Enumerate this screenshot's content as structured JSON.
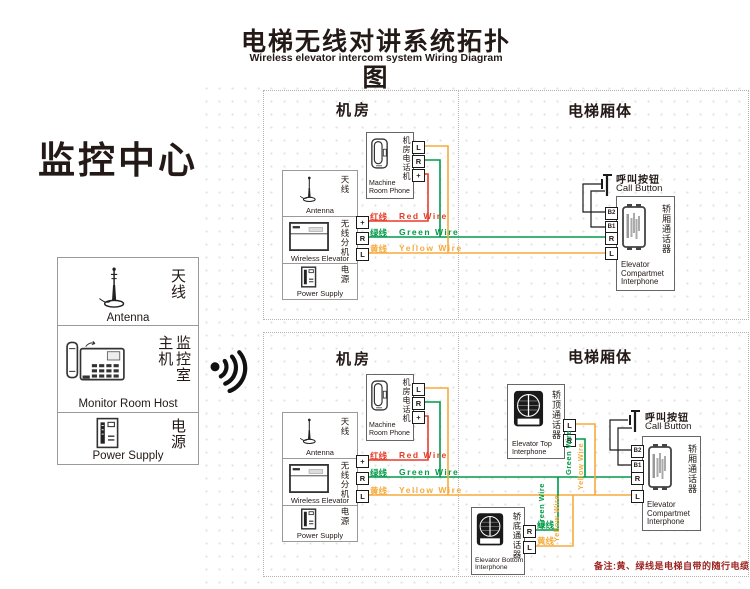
{
  "title": {
    "zh": "电梯无线对讲系统拓扑图",
    "en": "Wireless elevator intercom system Wiring Diagram"
  },
  "monitor_center": {
    "heading": "监控中心",
    "antenna": {
      "zh": "天线",
      "en": "Antenna"
    },
    "host": {
      "zh_left": "主机",
      "zh_right": "监控室",
      "en": "Monitor Room Host"
    },
    "power": {
      "zh": "电源",
      "en": "Power Supply"
    }
  },
  "section_headers": {
    "machine_room": "机房",
    "elevator_car": "电梯厢体"
  },
  "devices": {
    "machine_room_phone": {
      "zh": "机房电话机",
      "en1": "Machine",
      "en2": "Room Phone"
    },
    "antenna": {
      "zh": "天线",
      "en": "Antenna"
    },
    "wireless_extension": {
      "zh": "无线分机",
      "en": "Wireless Elevator"
    },
    "power": {
      "zh": "电源",
      "en": "Power Supply"
    },
    "call_button": {
      "zh": "呼叫按钮",
      "en": "Call Button"
    },
    "compartment_interphone": {
      "zh": "轿厢通话器",
      "en1": "Elevator",
      "en2": "Compartmet",
      "en3": "Interphone"
    },
    "top_interphone": {
      "zh": "轿顶通话器",
      "en1": "Elevator Top",
      "en2": "Interphone"
    },
    "bottom_interphone": {
      "zh": "轿底通话器",
      "en1": "Elevator Bottom",
      "en2": "Interphone"
    }
  },
  "terminals": {
    "l": "L",
    "r": "R",
    "plus": "+",
    "b1": "B1",
    "b2": "B2"
  },
  "wires": {
    "red": {
      "zh": "红线",
      "en": "Red Wire",
      "color": "#e63c28"
    },
    "green": {
      "zh": "绿线",
      "en": "Green Wire",
      "color": "#009a48"
    },
    "yellow": {
      "zh": "黄线",
      "en": "Yellow Wire",
      "color": "#f5ab3c"
    }
  },
  "note": {
    "text": "备注:黄、绿线是电梯自带的随行电缆",
    "color": "#9b2420"
  }
}
